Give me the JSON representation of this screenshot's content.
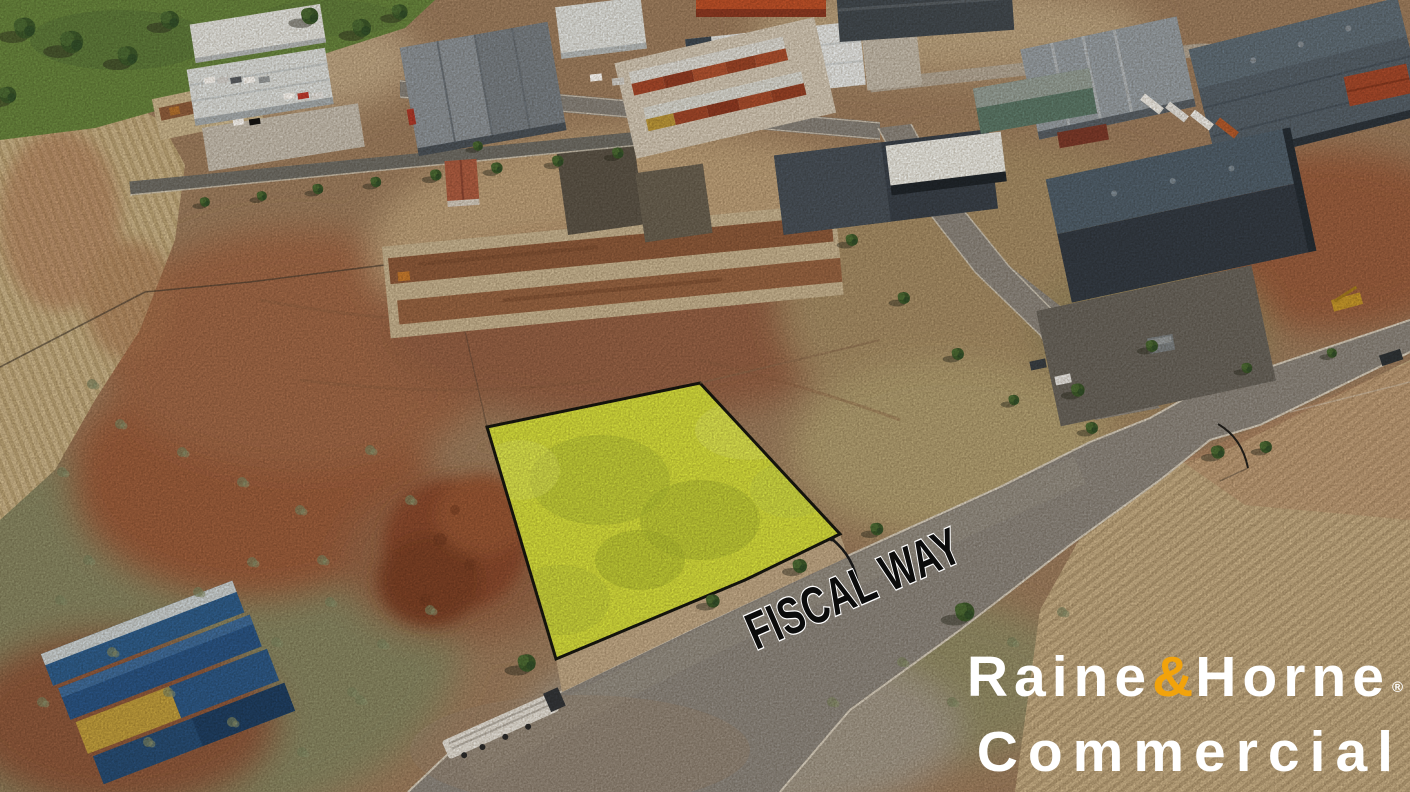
{
  "scene": {
    "type": "aerial-drone-photograph",
    "subject": "Vacant industrial land release with one allotment highlighted for sale on Fiscal Way, surrounded by warehouses, dirt paddocks and harvested farm fields",
    "street_label": "FISCAL WAY",
    "highlight_fill": "#d7e23d",
    "highlight_outline": "#16160f",
    "road_color": "#8f8a83",
    "kerb_color": "#dad3c5",
    "field_left_color": "#cdb88e",
    "field_right_color": "#c9b28a",
    "grass_color": "#69883f",
    "dirt_color": "#a07454",
    "red_dirt_color": "#9d5e3c"
  },
  "watermark": {
    "line1": {
      "word1": "Raine",
      "ampersand": "&",
      "word2": "Horne",
      "registered": "®"
    },
    "line2": "Commercial",
    "text_color": "#ffffff",
    "ampersand_color": "#F2A30B"
  }
}
